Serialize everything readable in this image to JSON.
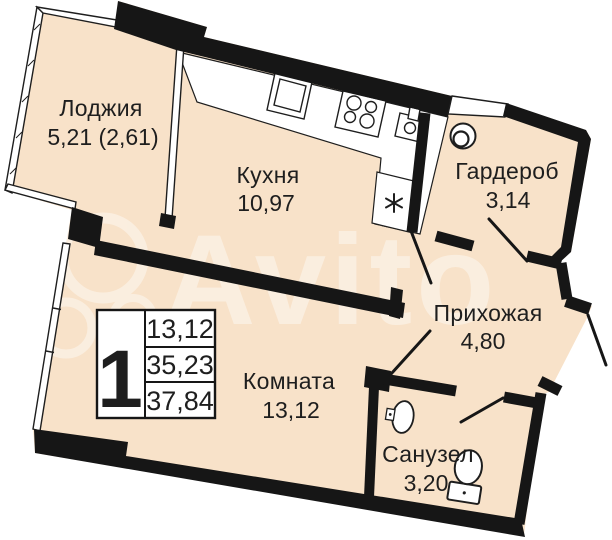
{
  "plan": {
    "title": "apartment-floor-plan",
    "rooms": [
      {
        "name": "Лоджия",
        "area": "5,21 (2,61)"
      },
      {
        "name": "Кухня",
        "area": "10,97"
      },
      {
        "name": "Гардероб",
        "area": "3,14"
      },
      {
        "name": "Прихожая",
        "area": "4,80"
      },
      {
        "name": "Комната",
        "area": "13,12"
      },
      {
        "name": "Санузел",
        "area": "3,20"
      }
    ],
    "legend": {
      "rooms_count": "1",
      "living_area": "13,12",
      "area_without_loggia": "35,23",
      "total_area": "37,84"
    },
    "watermark": "Avito",
    "colors": {
      "floor": "#f8e2c9",
      "wall": "#161616",
      "background": "#ffffff"
    }
  }
}
